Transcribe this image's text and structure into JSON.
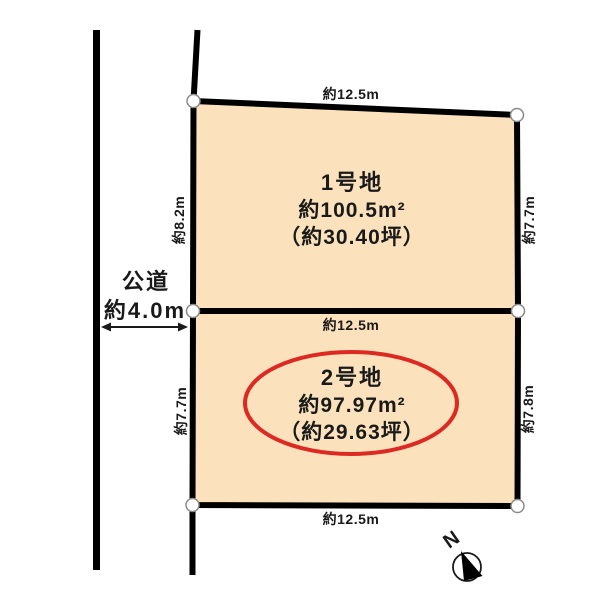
{
  "diagram": {
    "title": "lot-layout-plan",
    "road": {
      "name": "公道",
      "width_label": "約4.0m"
    },
    "lots": [
      {
        "name": "1号地",
        "area_sqm": "約100.5m²",
        "area_tsubo": "（約30.40坪）",
        "dim_top": "約12.5m",
        "dim_left": "約8.2m",
        "dim_right": "約7.7m"
      },
      {
        "name": "2号地",
        "area_sqm": "約97.97m²",
        "area_tsubo": "（約29.63坪）",
        "dim_top": "約12.5m",
        "dim_left": "約7.7m",
        "dim_right": "約7.8m",
        "dim_bottom": "約12.5m",
        "highlighted": true
      }
    ],
    "compass": {
      "label": "N"
    },
    "colors": {
      "lot_fill": "#FBE2BD",
      "line": "#000000",
      "highlight_red": "#DC2A23",
      "dot_fill": "#FFFFFF",
      "dot_stroke": "#8A8A8A",
      "background": "#FFFFFF"
    }
  }
}
